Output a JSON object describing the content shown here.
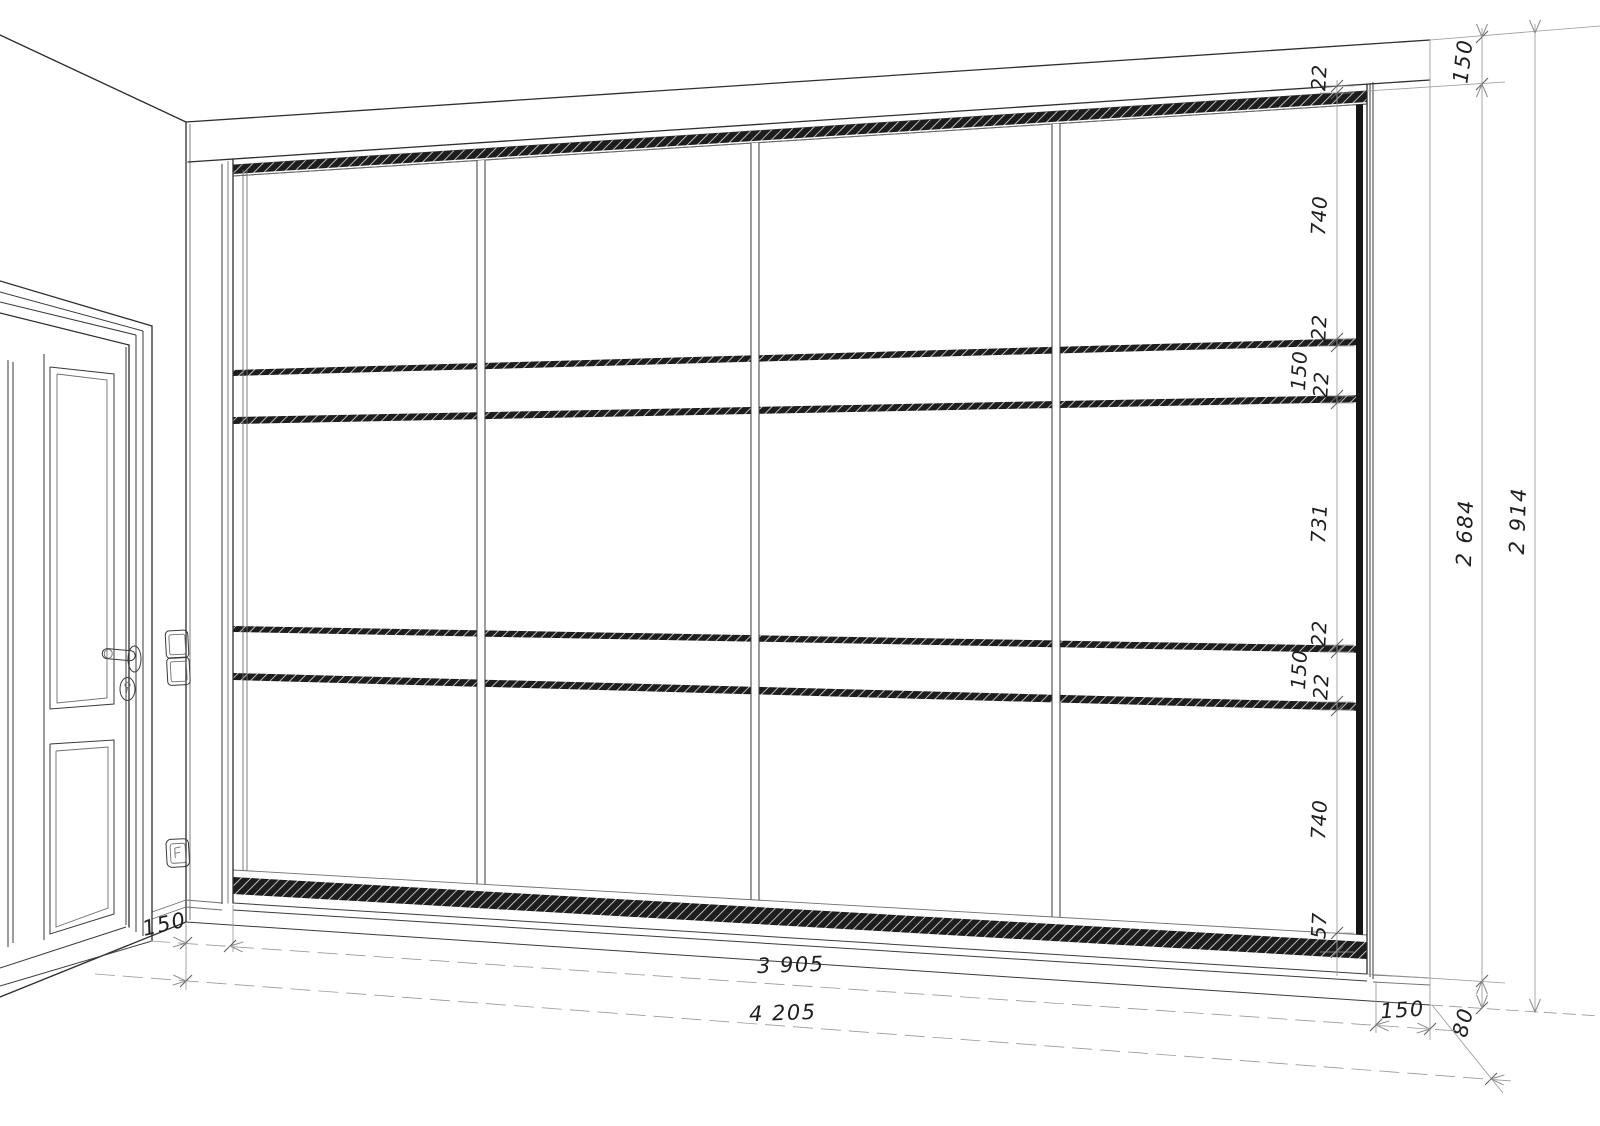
{
  "drawing": {
    "type": "wardrobe-elevation-perspective",
    "dims": {
      "chain": [
        "22",
        "740",
        "22",
        "150",
        "22",
        "731",
        "22",
        "150",
        "22",
        "740",
        "57"
      ],
      "right_side": {
        "ceiling_gap": "150",
        "wardrobe_height": "2 684",
        "wall_height": "2 914",
        "plinth_height": "80"
      },
      "bottom": {
        "left_gap": "150",
        "doors_width": "3 905",
        "wall_width": "4 205",
        "right_gap": "150"
      }
    }
  }
}
